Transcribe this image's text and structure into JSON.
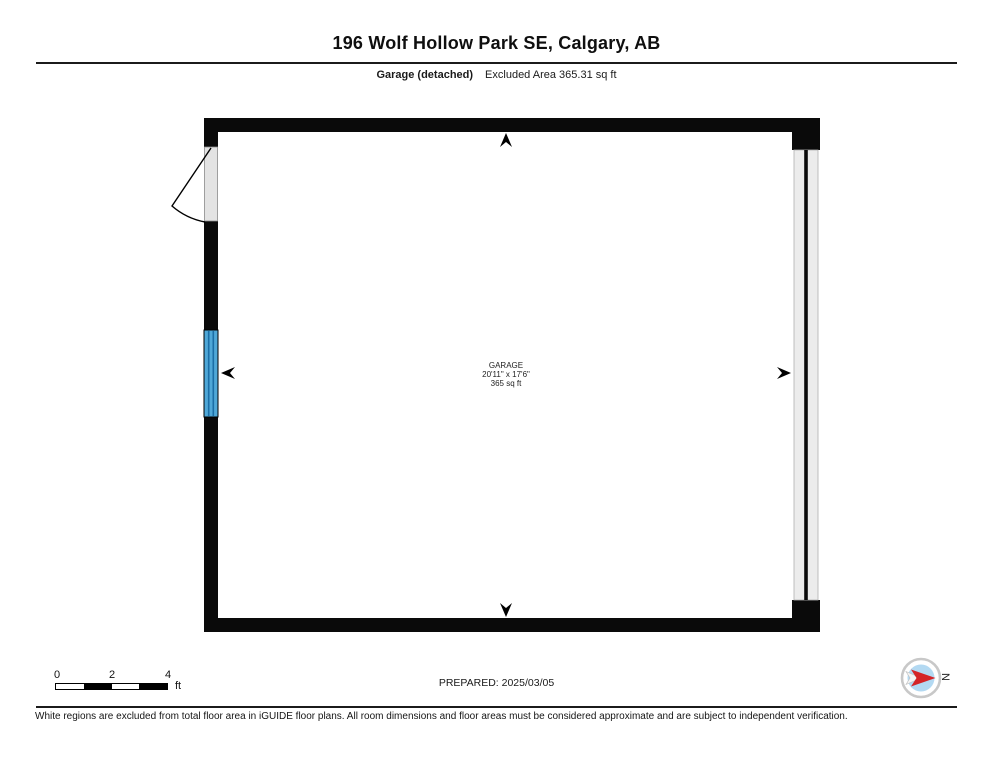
{
  "header": {
    "title": "196 Wolf Hollow Park SE, Calgary, AB",
    "floor_label": "Garage (detached)",
    "excluded_area": "Excluded Area 365.31 sq ft"
  },
  "room": {
    "name": "GARAGE",
    "dimensions": "20'11\" x 17'6\"",
    "area": "365 sq ft"
  },
  "footer": {
    "scale_bar": {
      "ticks": [
        "0",
        "2",
        "4"
      ],
      "unit": "ft"
    },
    "prepared": "PREPARED: 2025/03/05",
    "compass_label": "N"
  },
  "disclaimer": "White regions are excluded from total floor area in iGUIDE floor plans. All room dimensions and floor areas must be considered approximate and are subject to independent verification.",
  "colors": {
    "wall": "#0a0a0a",
    "window_fill": "#4fa8d8",
    "window_line": "#1b6ea6",
    "door_fill": "#e3e3e3",
    "door_swing": "#000000",
    "garage_door_fill": "#ececec",
    "garage_door_line": "#0a0a0a",
    "compass_inner": "#b3d9f2",
    "compass_arrow": "#d42427",
    "compass_ring": "#c8c8c8"
  }
}
